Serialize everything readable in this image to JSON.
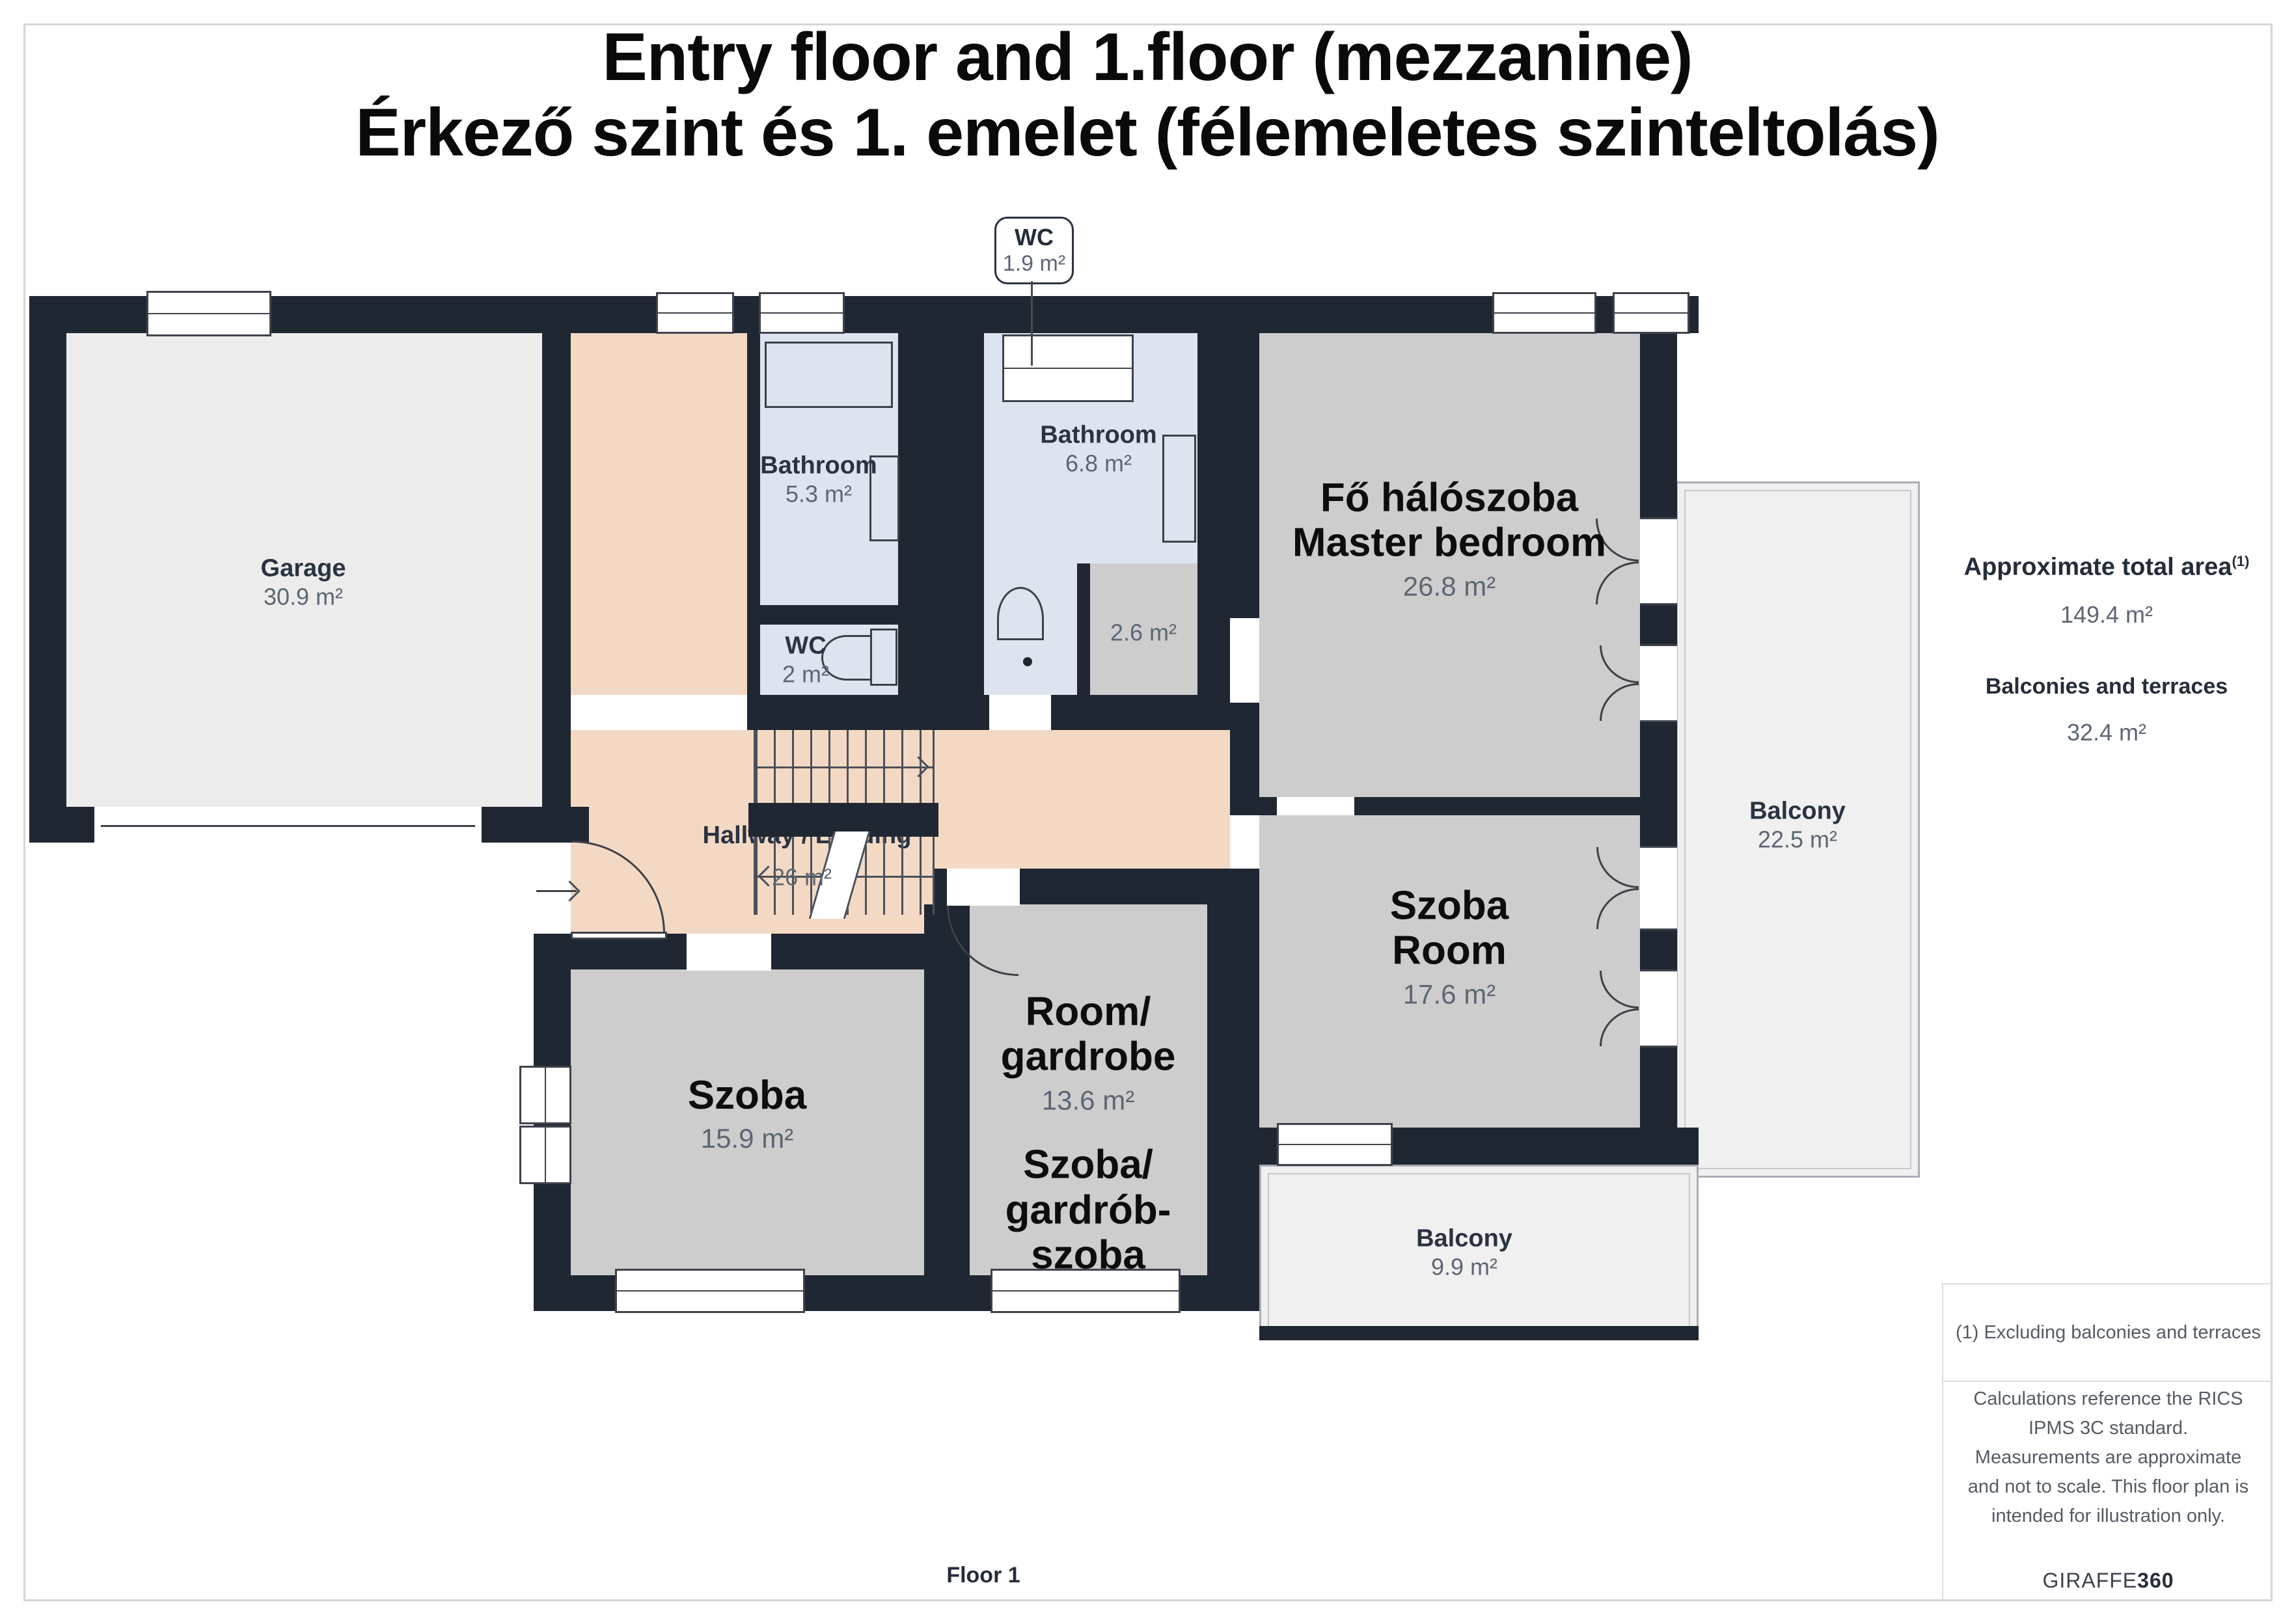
{
  "title": {
    "line1": "Entry floor and 1.floor (mezzanine)",
    "line2": "Érkező szint és 1. emelet (félemeletes szinteltolás)"
  },
  "callout": {
    "name": "WC",
    "area": "1.9 m²"
  },
  "rooms": {
    "garage": {
      "name": "Garage",
      "area": "30.9 m²"
    },
    "bathroom_left": {
      "name": "Bathroom",
      "area": "5.3 m²"
    },
    "wc_small": {
      "name": "WC",
      "area": "2 m²"
    },
    "bathroom_center": {
      "name": "Bathroom",
      "area": "6.8 m²"
    },
    "niche": {
      "area": "2.6 m²"
    },
    "hallway": {
      "name": "Hallway / Landing",
      "area": "26 m²"
    },
    "master_bedroom": {
      "name_hu": "Fő hálószoba",
      "name_en": "Master bedroom",
      "area": "26.8 m²"
    },
    "room_right": {
      "name_hu": "Szoba",
      "name_en": "Room",
      "area": "17.6 m²"
    },
    "room_left": {
      "name": "Szoba",
      "area": "15.9 m²"
    },
    "wardrobe": {
      "name_en_1": "Room/",
      "name_en_2": "gardrobe",
      "area": "13.6 m²",
      "name_hu_1": "Szoba/",
      "name_hu_2": "gardrób-",
      "name_hu_3": "szoba"
    },
    "balcony_right": {
      "name": "Balcony",
      "area": "22.5 m²"
    },
    "balcony_bottom": {
      "name": "Balcony",
      "area": "9.9 m²"
    }
  },
  "sidebar": {
    "total_area_label": "Approximate total area",
    "total_area_sup": "(1)",
    "total_area_value": "149.4 m²",
    "balconies_label": "Balconies and terraces",
    "balconies_value": "32.4 m²",
    "footnote": "(1) Excluding balconies and terraces",
    "disclaimer": "Calculations reference the RICS IPMS 3C standard. Measurements are approximate and not to scale. This floor plan is intended for illustration only.",
    "logo_text": "GIRAFFE",
    "logo_suffix": "360"
  },
  "footer": {
    "floor_label": "Floor 1"
  },
  "colors": {
    "wall": "#1f2733",
    "hallway": "#f3d9c4",
    "bathroom": "#dee3f0",
    "room": "#cdcdcd",
    "garage": "#ececec",
    "balcony": "#f0f0f1",
    "label_navy": "#2a3342",
    "area_gray": "#5d6673",
    "big_label": "#0d0d0d"
  }
}
